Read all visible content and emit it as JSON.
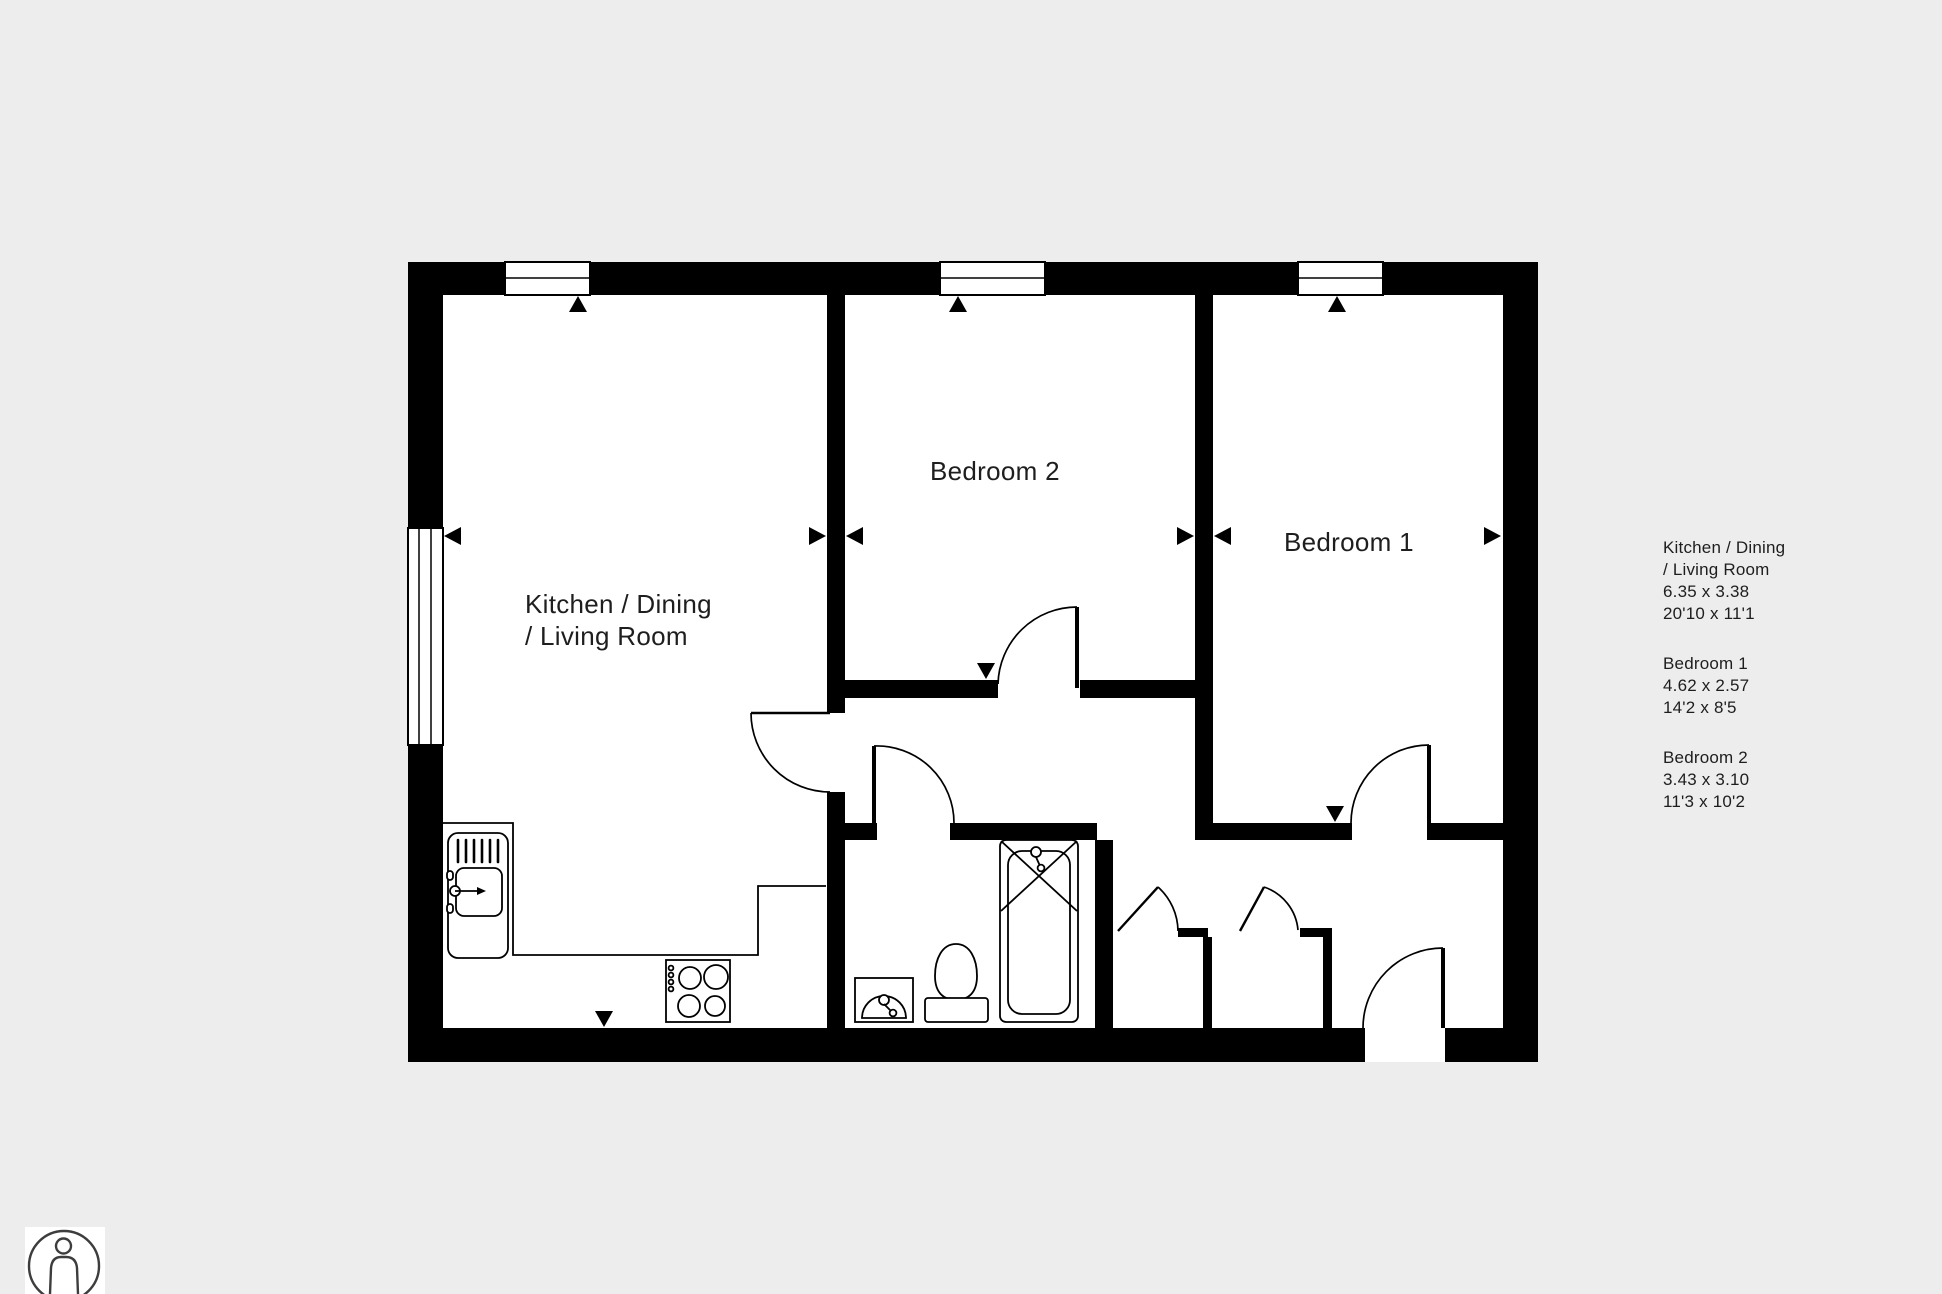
{
  "colors": {
    "background": "#ededed",
    "walls": "#000000",
    "floor": "#ffffff",
    "text": "#1e1e1e"
  },
  "plan": {
    "rooms": [
      {
        "id": "kitchen-dining-living",
        "label_line1": "Kitchen / Dining",
        "label_line2": "/ Living Room"
      },
      {
        "id": "bedroom-2",
        "label": "Bedroom 2"
      },
      {
        "id": "bedroom-1",
        "label": "Bedroom 1"
      }
    ],
    "fixtures": [
      "kitchen-sink",
      "hob",
      "kitchen-counter",
      "toilet",
      "bathtub",
      "washbasin"
    ],
    "door_count": 6,
    "window_count": 4
  },
  "legend": {
    "entries": [
      {
        "name_line1": "Kitchen / Dining",
        "name_line2": "/ Living Room",
        "metric": "6.35 x 3.38",
        "imperial": "20'10 x 11'1"
      },
      {
        "name": "Bedroom 1",
        "metric": "4.62 x 2.57",
        "imperial": "14'2 x 8'5"
      },
      {
        "name": "Bedroom 2",
        "metric": "3.43 x 3.10",
        "imperial": "11'3 x 10'2"
      }
    ]
  },
  "icons": {
    "scale_figure": "person-in-circle"
  }
}
